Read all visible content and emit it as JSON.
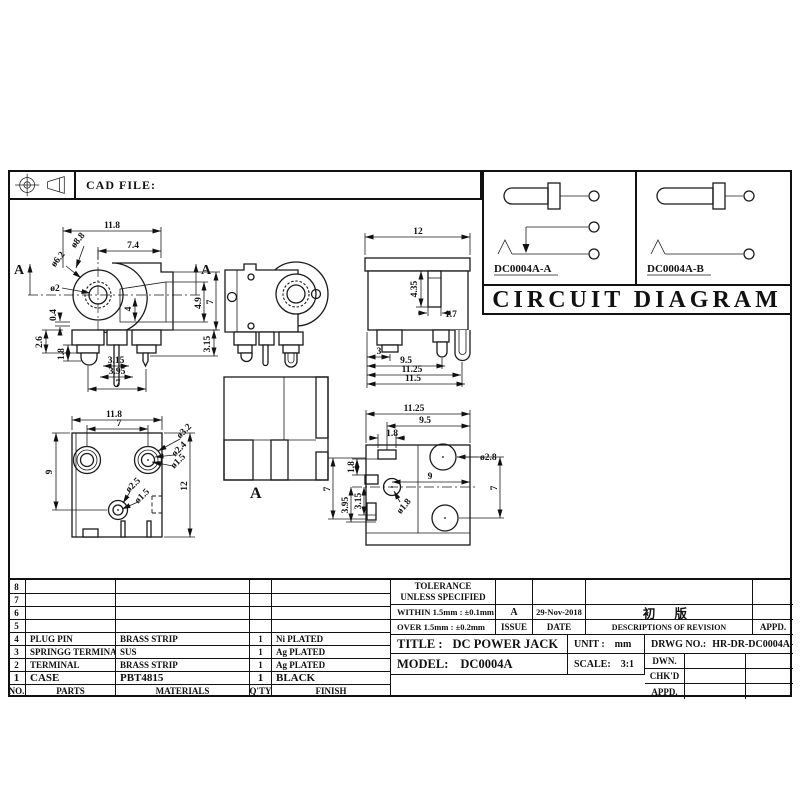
{
  "header": {
    "cad_file": "CAD FILE:"
  },
  "circuit": {
    "title": "CIRCUIT DIAGRAM",
    "variant_a": "DC0004A-A",
    "variant_b": "DC0004A-B"
  },
  "dims": {
    "front": {
      "w": "11.8",
      "w2": "7.4",
      "d1": "ø8.8",
      "d2": "ø6.2",
      "d3": "ø2",
      "h1": "4.9",
      "h2": "7",
      "h3": "4",
      "l1": "0.4",
      "l2": "2.6",
      "l3": "1.8",
      "b1": "3.15",
      "b2": "3.95",
      "b3": "7",
      "r1": "3.15",
      "sec_left": "A",
      "sec_right": "A"
    },
    "side": {
      "w": "12",
      "slot_h": "4.35",
      "slot_w": "1.7",
      "b1": "3",
      "b2": "9.5",
      "b3": "11.25",
      "b4": "11.5"
    },
    "bottom": {
      "w": "11.8",
      "w2": "7",
      "hl": "9",
      "hr": "12",
      "d1": "ø3.2",
      "d2": "ø2.4",
      "d3": "ø1.5",
      "d4": "ø2.5",
      "d5": "ø1.5"
    },
    "section": {
      "label": "A"
    },
    "pcb": {
      "w": "11.25",
      "w2": "9.5",
      "w3": "1.8",
      "d1": "ø2.8",
      "mid": "9",
      "hr": "7",
      "d2": "ø1.8",
      "l1": "1.8",
      "l2": "3.15",
      "l3": "3.95",
      "l4": "7"
    }
  },
  "parts_table": {
    "headers": {
      "no": "NO.",
      "parts": "PARTS",
      "materials": "MATERIALS",
      "qty": "Q'TY",
      "finish": "FINISH"
    },
    "rows": [
      {
        "no": "8",
        "parts": "",
        "materials": "",
        "qty": "",
        "finish": ""
      },
      {
        "no": "7",
        "parts": "",
        "materials": "",
        "qty": "",
        "finish": ""
      },
      {
        "no": "6",
        "parts": "",
        "materials": "",
        "qty": "",
        "finish": ""
      },
      {
        "no": "5",
        "parts": "",
        "materials": "",
        "qty": "",
        "finish": ""
      },
      {
        "no": "4",
        "parts": "PLUG PIN",
        "materials": "BRASS STRIP",
        "qty": "1",
        "finish": "Ni PLATED"
      },
      {
        "no": "3",
        "parts": "SPRINGG TERMINAL",
        "materials": "SUS",
        "qty": "1",
        "finish": "Ag PLATED"
      },
      {
        "no": "2",
        "parts": "TERMINAL",
        "materials": "BRASS STRIP",
        "qty": "1",
        "finish": "Ag PLATED"
      },
      {
        "no": "1",
        "parts": "CASE",
        "materials": "PBT4815",
        "qty": "1",
        "finish": "BLACK"
      }
    ]
  },
  "title_block": {
    "tolerance_1": "TOLERANCE",
    "tolerance_2": "UNLESS  SPECIFIED",
    "within": "WITHIN 1.5mm : ±0.1mm",
    "over": "OVER 1.5mm : ±0.2mm",
    "issue_value": "A",
    "issue_label": "ISSUE",
    "date_value": "29-Nov-2018",
    "date_label": "DATE",
    "revision_value": "初 版",
    "revision_label": "DESCRIPTIONS OF REVISION",
    "appd_label": "APPD.",
    "title_label": "TITLE :",
    "title_value": "DC POWER JACK",
    "unit_label": "UNIT :",
    "unit_value": "mm",
    "drwg_label": "DRWG NO.:",
    "drwg_value": "HR-DR-DC0004A-00",
    "model_label": "MODEL:",
    "model_value": "DC0004A",
    "scale_label": "SCALE:",
    "scale_value": "3:1",
    "dwn_label": "DWN.",
    "chkd_label": "CHK'D",
    "appd2_label": "APPD."
  }
}
